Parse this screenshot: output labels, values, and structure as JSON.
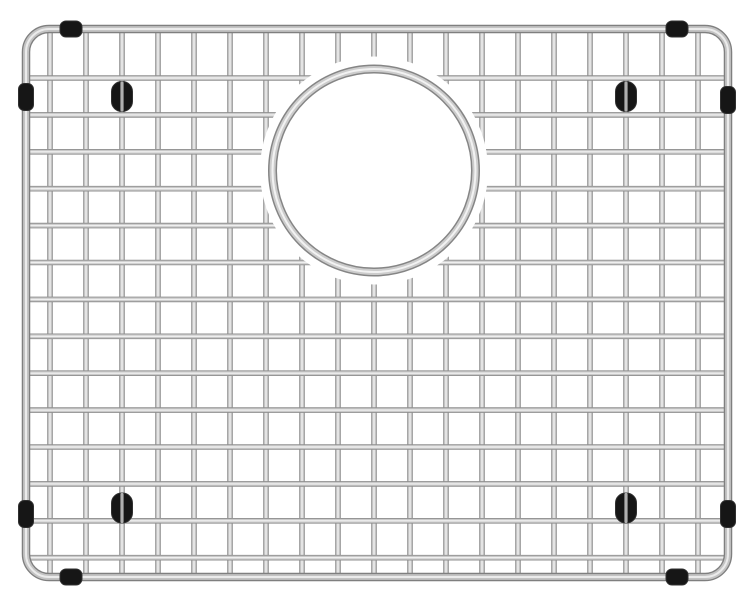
{
  "meta": {
    "type": "product-photo",
    "alt_text": "Stainless steel wire sink bottom grid with rounded corners, a circular drain opening near the upper center, black rubber bumpers on the frame edges, and black oval protective feet near each corner",
    "background_color": "#ffffff"
  },
  "scene": {
    "canvas": {
      "width": 755,
      "height": 606
    },
    "colors": {
      "background": "#ffffff",
      "wire_edge": "#8f8f8f",
      "wire_mid": "#c9c9c9",
      "wire_highlight": "#efefef",
      "frame_edge": "#7f7f7f",
      "frame_mid": "#c3c3c3",
      "frame_highlight": "#ebebeb",
      "ring_edge": "#858585",
      "ring_mid": "#cccccc",
      "ring_highlight": "#f2f2f2",
      "rubber_black": "#161616",
      "rubber_outline": "#303030",
      "foot_wire": "#b0b0b0"
    },
    "frame": {
      "x": 26,
      "y": 29,
      "width": 702,
      "height": 548,
      "corner_radius": 23
    },
    "grid": {
      "vertical_wires": {
        "count": 19,
        "start_x": 50,
        "spacing": 36.0
      },
      "horizontal_wires": {
        "count": 14,
        "start_y": 78,
        "spacing": 36.9
      }
    },
    "drain_opening": {
      "cx": 374,
      "cy": 170.5,
      "halo_radius": 114,
      "ring_radius": 101.5
    },
    "edge_bumpers": {
      "top_size": {
        "w": 22,
        "h": 16
      },
      "side_size": {
        "w": 15,
        "h": 27
      },
      "top": [
        {
          "cx": 71
        },
        {
          "cx": 677
        }
      ],
      "bottom": [
        {
          "cx": 71
        },
        {
          "cx": 677
        }
      ],
      "left": [
        {
          "cy": 97
        },
        {
          "cy": 514
        }
      ],
      "right": [
        {
          "cy": 100
        },
        {
          "cy": 514
        }
      ]
    },
    "feet": {
      "size": {
        "w": 21,
        "h": 30
      },
      "positions": [
        {
          "cx": 122,
          "cy": 96.5
        },
        {
          "cx": 626,
          "cy": 96.5
        },
        {
          "cx": 122,
          "cy": 508
        },
        {
          "cx": 626,
          "cy": 508
        }
      ]
    }
  }
}
